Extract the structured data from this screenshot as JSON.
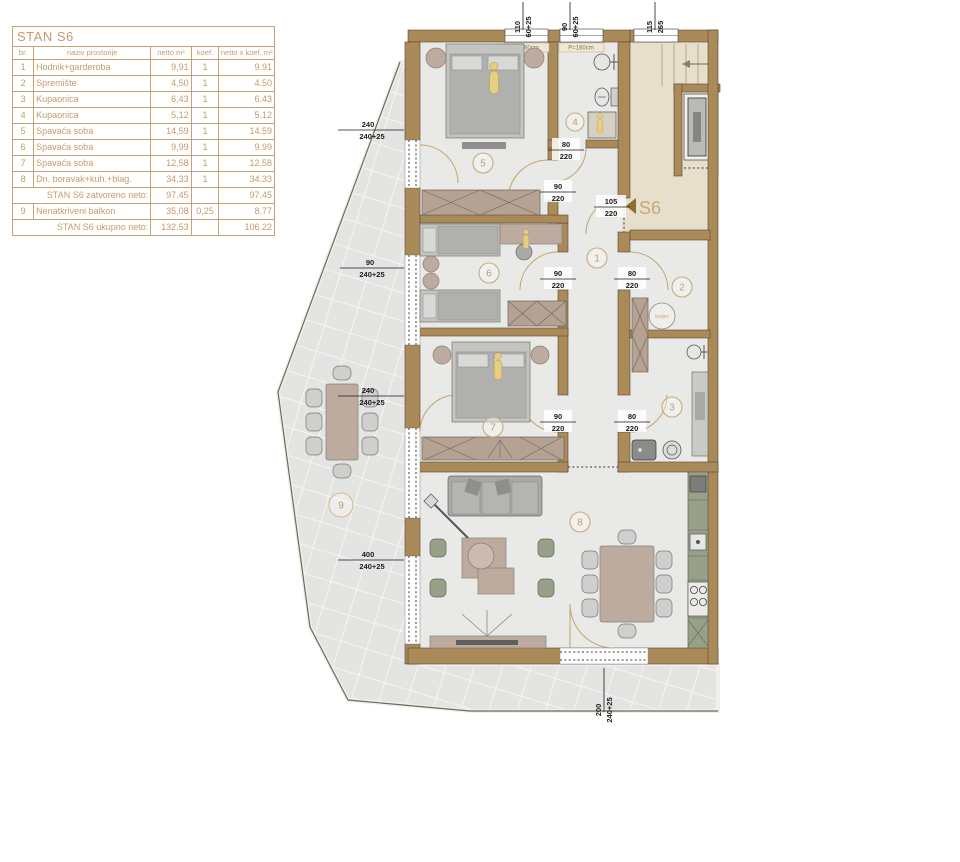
{
  "table": {
    "title": "STAN S6",
    "headers": {
      "num": "br.",
      "name": "naziv prostorije",
      "netto": "netto m²",
      "koef": "koef.",
      "result": "netto x koef. m²"
    },
    "rows": [
      {
        "num": "1",
        "name": "Hodnik+garderoba",
        "netto": "9,91",
        "koef": "1",
        "result": "9.91"
      },
      {
        "num": "2",
        "name": "Spremište",
        "netto": "4,50",
        "koef": "1",
        "result": "4.50"
      },
      {
        "num": "3",
        "name": "Kupaonica",
        "netto": "6,43",
        "koef": "1",
        "result": "6.43"
      },
      {
        "num": "4",
        "name": "Kupaonica",
        "netto": "5,12",
        "koef": "1",
        "result": "5.12"
      },
      {
        "num": "5",
        "name": "Spavaća soba",
        "netto": "14,59",
        "koef": "1",
        "result": "14.59"
      },
      {
        "num": "6",
        "name": "Spavaća soba",
        "netto": "9,99",
        "koef": "1",
        "result": "9.99"
      },
      {
        "num": "7",
        "name": "Spavaća soba",
        "netto": "12,58",
        "koef": "1",
        "result": "12.58"
      },
      {
        "num": "8",
        "name": "Dn. boravak+kuh.+blag.",
        "netto": "34,33",
        "koef": "1",
        "result": "34.33"
      },
      {
        "num": "",
        "name": "STAN S6 zatvoreno neto:",
        "netto": "97.45",
        "koef": "",
        "result": "97.45"
      },
      {
        "num": "9",
        "name": "Nenatkriveni balkon",
        "netto": "35,08",
        "koef": "0,25",
        "result": "8.77"
      },
      {
        "num": "",
        "name": "STAN S6 ukupno neto:",
        "netto": "132.53",
        "koef": "",
        "result": "106.22"
      }
    ]
  },
  "plan": {
    "rooms": {
      "n1": "1",
      "n2": "2",
      "n3": "3",
      "n4": "4",
      "n5": "5",
      "n6": "6",
      "n7": "7",
      "n8": "8",
      "n9": "9"
    },
    "entrance_label": "S6",
    "bojler_label": "bojler",
    "window_label": "P=160cm",
    "dims": {
      "w110": {
        "a": "110",
        "b": "60+25"
      },
      "w90t": {
        "a": "90",
        "b": "60+25"
      },
      "w115": {
        "a": "115",
        "b": "265"
      },
      "d80": {
        "a": "80",
        "b": "220"
      },
      "d90": {
        "a": "90",
        "b": "220"
      },
      "d105": {
        "a": "105",
        "b": "220"
      },
      "b240": {
        "a": "240",
        "b": "240+25"
      },
      "b90": {
        "a": "90",
        "b": "240+25"
      },
      "b400": {
        "a": "400",
        "b": "240+25"
      },
      "b200": {
        "a": "200",
        "b": "240+25"
      }
    },
    "colors": {
      "wall": "#ab8a5a",
      "accent": "#c9a878",
      "floor": "#e9e9e7",
      "common_area": "#e7decb",
      "kitchen": "#99a089",
      "tile": "#e4e4e2",
      "dim_text": "#1b1b1b"
    }
  }
}
